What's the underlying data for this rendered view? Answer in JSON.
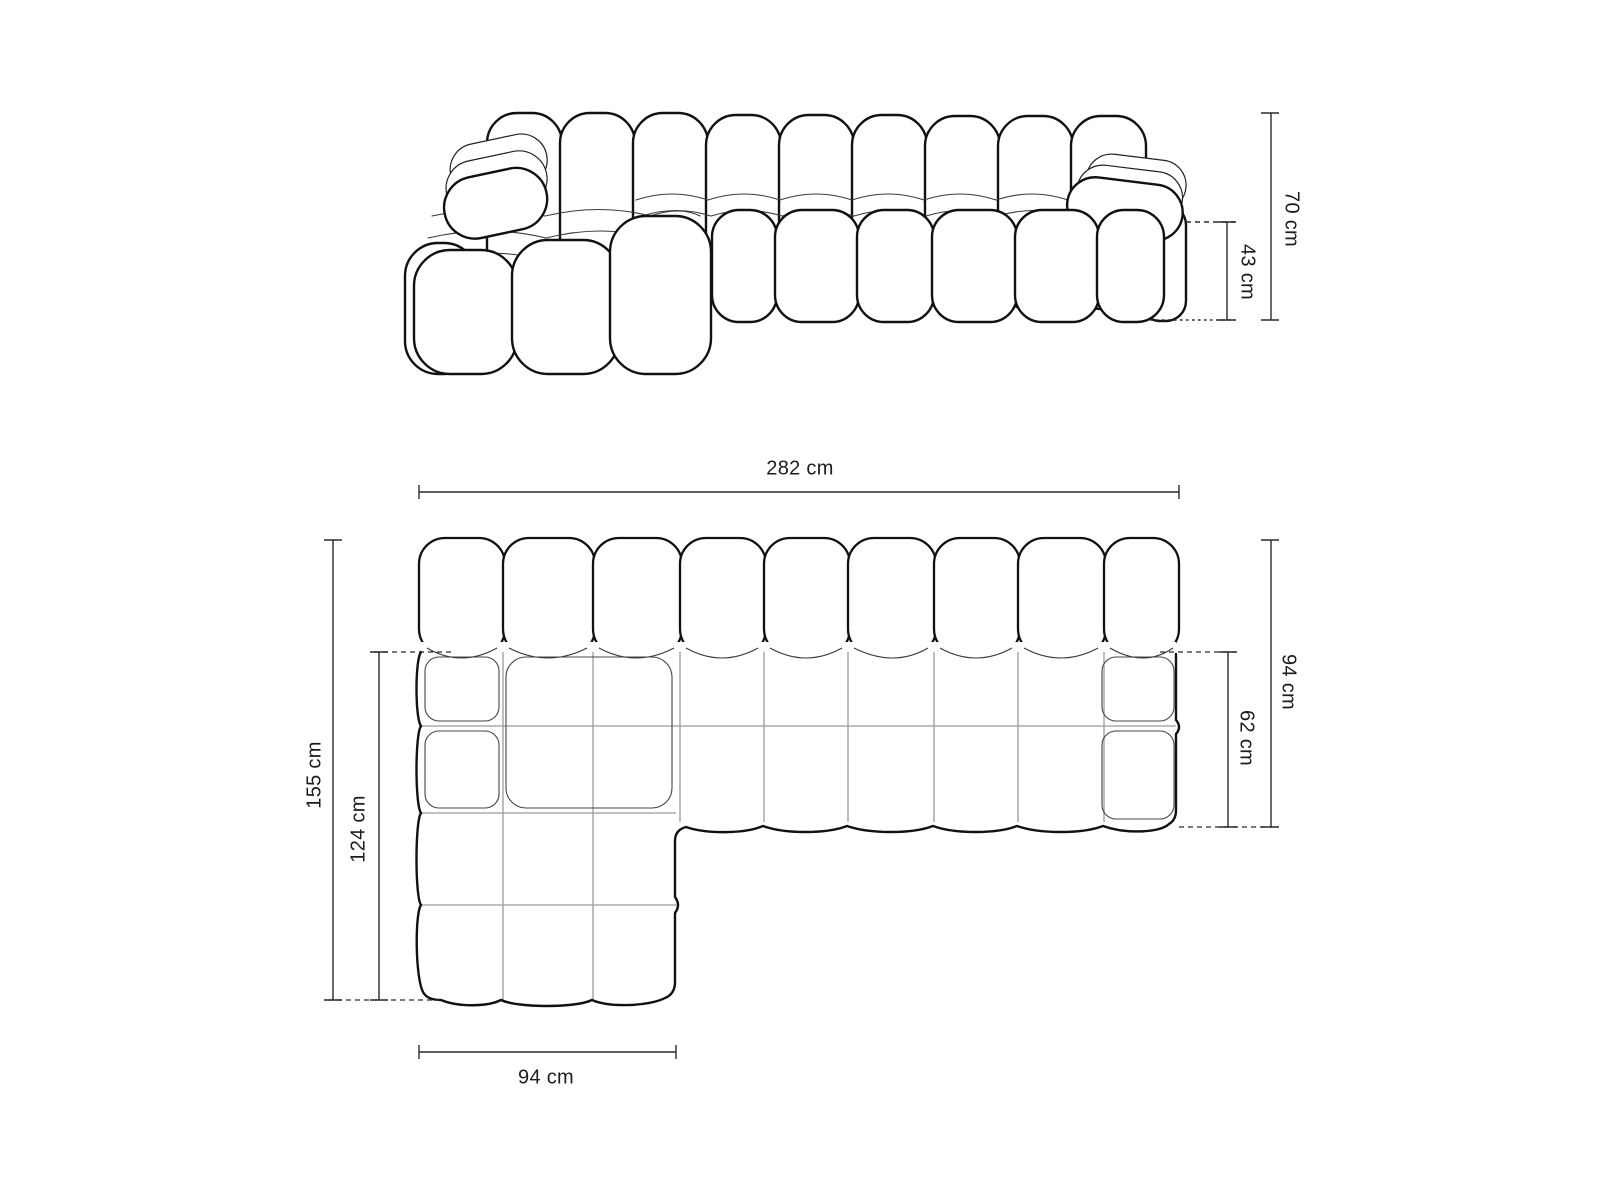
{
  "diagram": {
    "type": "sofa-dimension-drawing",
    "description": "Modular corner sofa technical drawing, front elevation and top plan view with dimensions",
    "front_view": {
      "dims": [
        {
          "id": "total-height",
          "label": "70 cm"
        },
        {
          "id": "seat-height",
          "label": "43 cm"
        }
      ]
    },
    "top_view": {
      "dims": [
        {
          "id": "total-width",
          "label": "282 cm"
        },
        {
          "id": "total-depth",
          "label": "94 cm"
        },
        {
          "id": "seat-depth",
          "label": "62 cm"
        },
        {
          "id": "chaise-total-length",
          "label": "155 cm"
        },
        {
          "id": "chaise-inner-length",
          "label": "124 cm"
        },
        {
          "id": "chaise-width",
          "label": "94 cm"
        }
      ]
    },
    "colors": {
      "outline": "#111111",
      "thin_line": "#3a3a3a",
      "grid_line": "#9b9b9b",
      "dim_line": "#2a2a2a",
      "text": "#1c1c1c",
      "background": "#ffffff"
    }
  }
}
